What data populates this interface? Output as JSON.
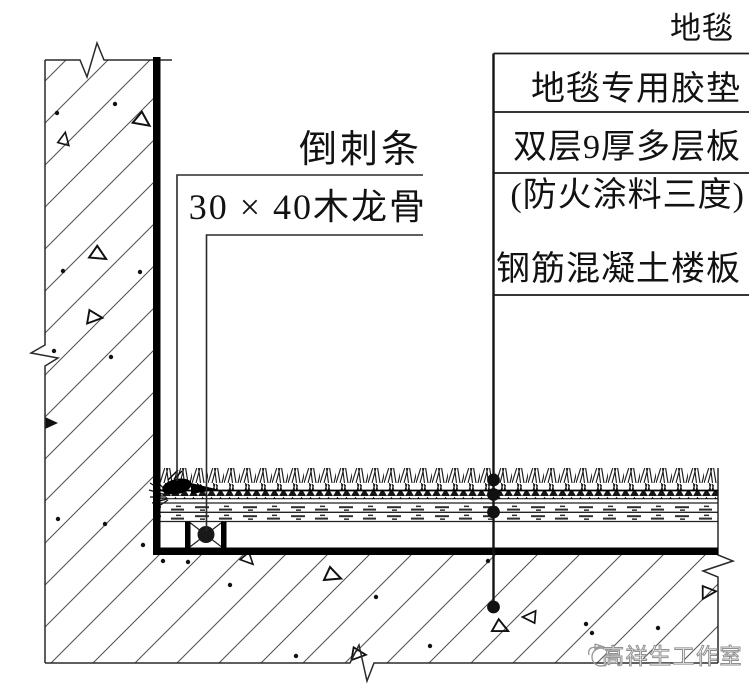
{
  "drawing": {
    "type": "architectural-flooring-detail",
    "labels": {
      "right": [
        {
          "text": "地毯"
        },
        {
          "text": "地毯专用胶垫"
        },
        {
          "text": "双层9厚多层板"
        },
        {
          "text": "(防火涂料三度)"
        },
        {
          "text": "钢筋混凝土楼板"
        }
      ],
      "left": [
        {
          "text": "倒刺条"
        },
        {
          "text": "30 × 40木龙骨"
        }
      ]
    },
    "watermark": {
      "text": "高祥生工作室"
    },
    "colors": {
      "ink": "#111111",
      "hatch_line": "#555555",
      "watermark_gray": "#8f8f8f"
    }
  }
}
